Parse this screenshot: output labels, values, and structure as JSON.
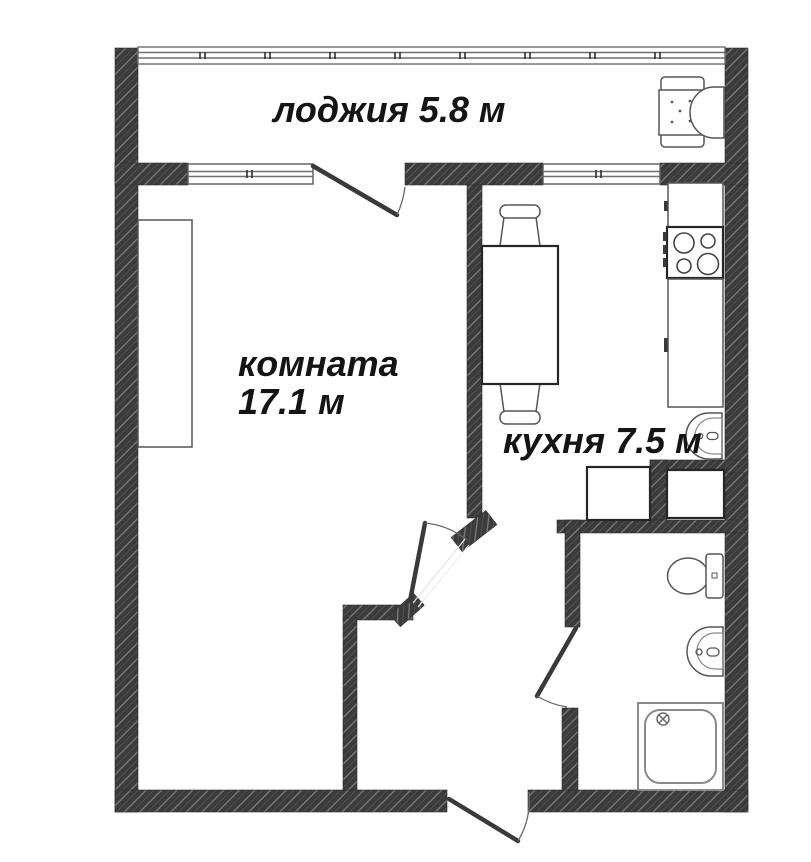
{
  "page": {
    "type": "apartment-floor-plan"
  },
  "labels": {
    "loggia": "лоджия 5.8 м",
    "room_name": "комната",
    "room_area": "17.1 м",
    "kitchen": "кухня 7.5 м"
  },
  "colors": {
    "wall_fill": "#3b3b3b",
    "wall_hatch_line": "#7d7d7d",
    "fixture_outline": "#565656",
    "dark_outline": "#262626",
    "door_line": "#3a3a3a",
    "label_text": "#141414",
    "background": "#ffffff"
  },
  "fixtures": [
    "loggia-glazing",
    "room-window",
    "kitchen-window",
    "balcony-door",
    "room-door",
    "bathroom-door",
    "entrance-door",
    "wardrobe",
    "armchair",
    "dining-table",
    "chair-top",
    "chair-bottom",
    "kitchen-counter-upper",
    "stove",
    "kitchen-counter-lower",
    "kitchen-sink",
    "storage-cabinet-left",
    "storage-cabinet-right",
    "toilet",
    "washbasin",
    "shower-tray"
  ]
}
